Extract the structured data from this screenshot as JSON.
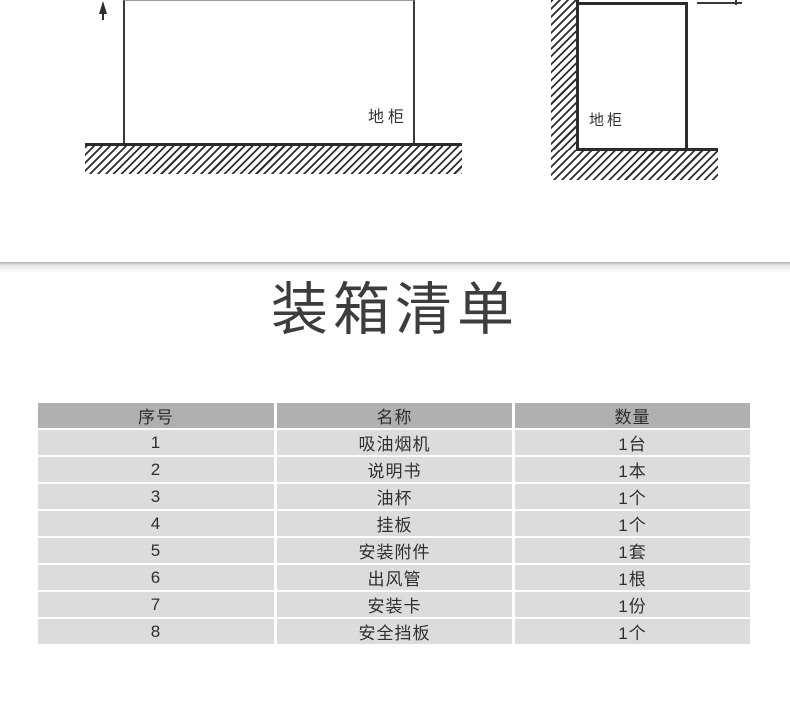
{
  "diagrams": {
    "left": {
      "cabinet_label": "地柜"
    },
    "right": {
      "cabinet_label": "地柜"
    }
  },
  "title": {
    "text": "装箱清单",
    "color": "#3d3d3d"
  },
  "table": {
    "headers": [
      "序号",
      "名称",
      "数量"
    ],
    "rows": [
      [
        "1",
        "吸油烟机",
        "1台"
      ],
      [
        "2",
        "说明书",
        "1本"
      ],
      [
        "3",
        "油杯",
        "1个"
      ],
      [
        "4",
        "挂板",
        "1个"
      ],
      [
        "5",
        "安装附件",
        "1套"
      ],
      [
        "6",
        "出风管",
        "1根"
      ],
      [
        "7",
        "安装卡",
        "1份"
      ],
      [
        "8",
        "安全挡板",
        "1个"
      ]
    ],
    "colors": {
      "header_bg": "#b0b0b0",
      "row_bg": "#dcdcdc",
      "text": "#2f2f2f"
    }
  }
}
